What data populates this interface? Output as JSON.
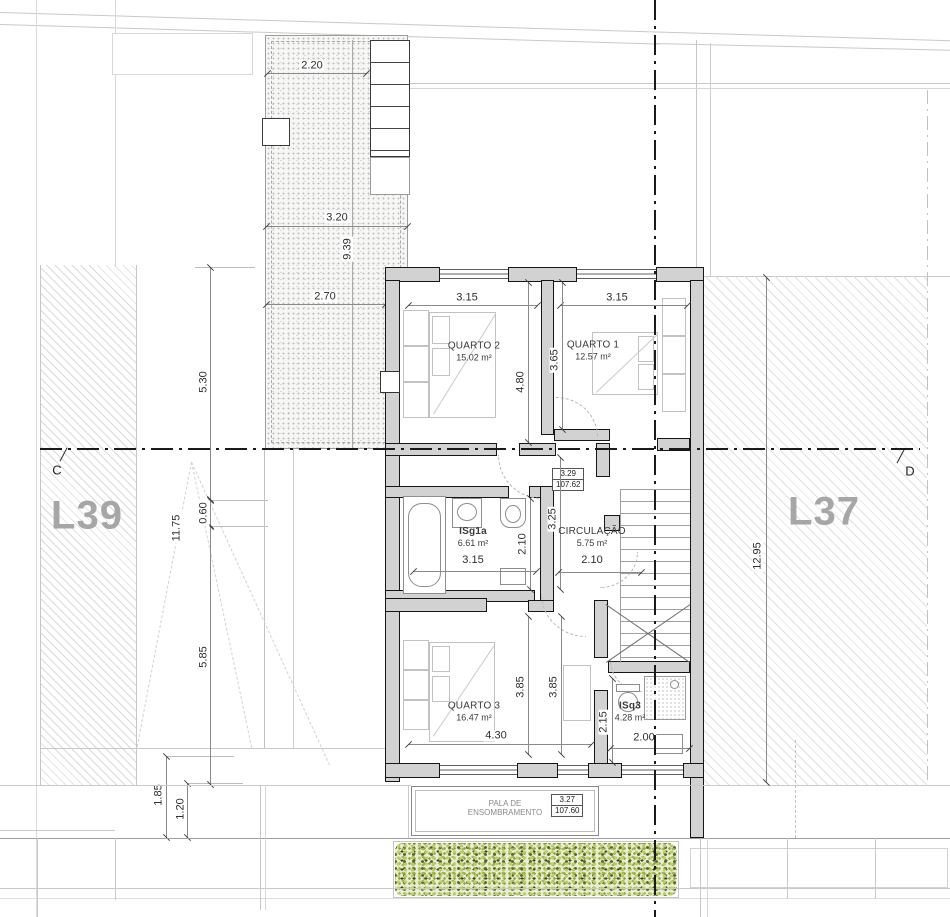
{
  "lots": {
    "left": "L39",
    "right": "L37"
  },
  "sections": {
    "left": "C",
    "right": "D"
  },
  "rooms": {
    "quarto2": {
      "name": "QUARTO 2",
      "area": "15.02 m²"
    },
    "quarto1": {
      "name": "QUARTO 1",
      "area": "12.57 m²"
    },
    "isg1a": {
      "name": "ISg1a",
      "area": "6.61 m²",
      "width": "3.15"
    },
    "circulacao": {
      "name": "CIRCULAÇÃO",
      "area": "5.75 m²",
      "width": "2.10"
    },
    "quarto3": {
      "name": "QUARTO 3",
      "area": "16.47 m²"
    },
    "isq3": {
      "name": "ISq3",
      "area": "4.28 m²"
    }
  },
  "levels": {
    "circ": {
      "height": "3.29",
      "elevation": "107.62"
    },
    "pala": {
      "height": "3.27",
      "elevation": "107.60"
    }
  },
  "pala": {
    "line1": "PALA DE",
    "line2": "ENSOMBRAMENTO"
  },
  "dims": {
    "patio_top": "2.20",
    "patio_mid": "3.20",
    "patio_len": "9.39",
    "patio_low": "2.70",
    "left_a": "5.30",
    "left_b": "0.60",
    "left_c": "5.85",
    "left_d": "1.85",
    "left_e": "1.20",
    "left_diag": "11.75",
    "q2_w": "3.15",
    "q2_d": "4.80",
    "q1_w": "3.15",
    "q1_d": "3.65",
    "bath_d": "2.10",
    "hall_d": "3.25",
    "q3_d1": "3.85",
    "q3_d2": "3.85",
    "q3_w": "4.30",
    "isq3_d": "2.15",
    "isq3_w": "2.00",
    "lot_right_len": "12.95"
  },
  "colors": {
    "wall_fill": "#d2d2d2",
    "line": "#161616",
    "hedge_light": "#b9cf62",
    "hedge_dark": "#39441f",
    "lot_label": "#a6a6a6"
  }
}
